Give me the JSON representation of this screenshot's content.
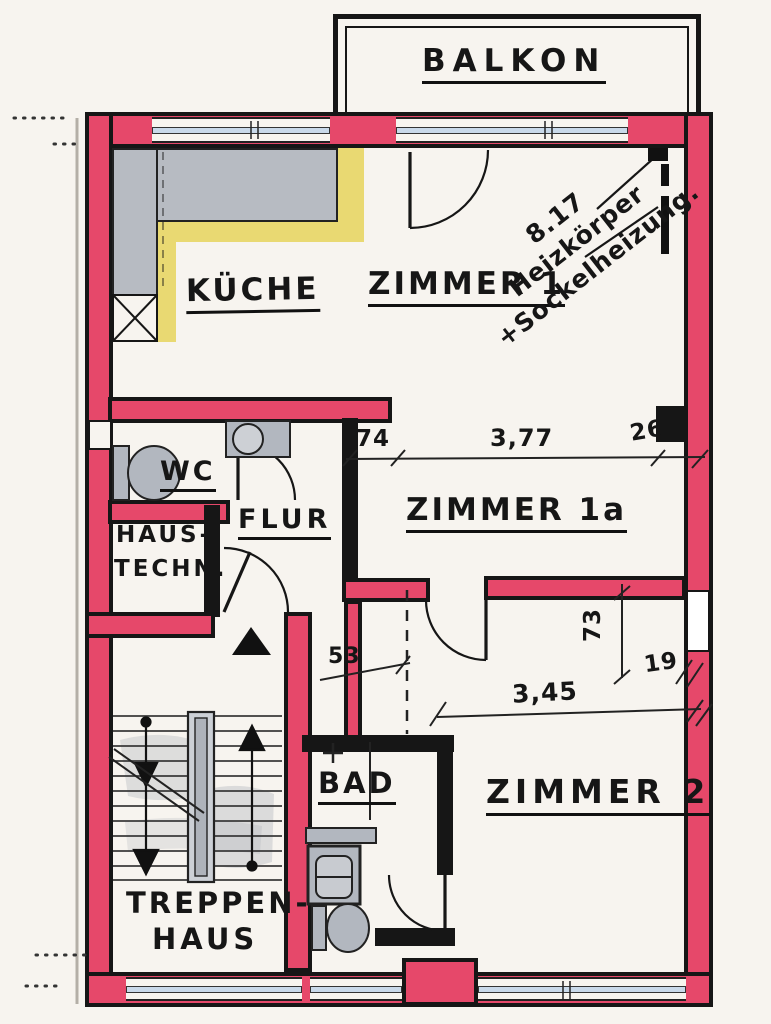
{
  "labels": {
    "balkon": "BALKON",
    "kueche": "KÜCHE",
    "zimmer1": "ZIMMER 1",
    "zimmer1a": "ZIMMER 1a",
    "zimmer2": "ZIMMER 2",
    "wc": "WC",
    "flur": "FLUR",
    "haustechnik1": "HAUS-",
    "haustechnik2": "TECHN.",
    "bad": "BAD",
    "treppenhaus1": "TREPPEN-",
    "treppenhaus2": "HAUS"
  },
  "dimensions": {
    "opening_left": "74",
    "opening_width": "3,77",
    "opening_right": "26",
    "passage_width": "53",
    "zimmer2_width": "3,45",
    "zimmer2_pier": "19",
    "zimmer2_recess": "73"
  },
  "note": {
    "l1": "8.17",
    "l2": "Heizkörper",
    "l3": "+Sockelheizung."
  },
  "colors": {
    "wall_red": "#e6486a",
    "window_glass": "#c9d9ea",
    "counter_gray": "#b7bbc2",
    "counter_yellow": "#e9d972",
    "fixture_gray": "#b2b7bf",
    "ink": "#161616",
    "paper": "#f7f4ef"
  }
}
